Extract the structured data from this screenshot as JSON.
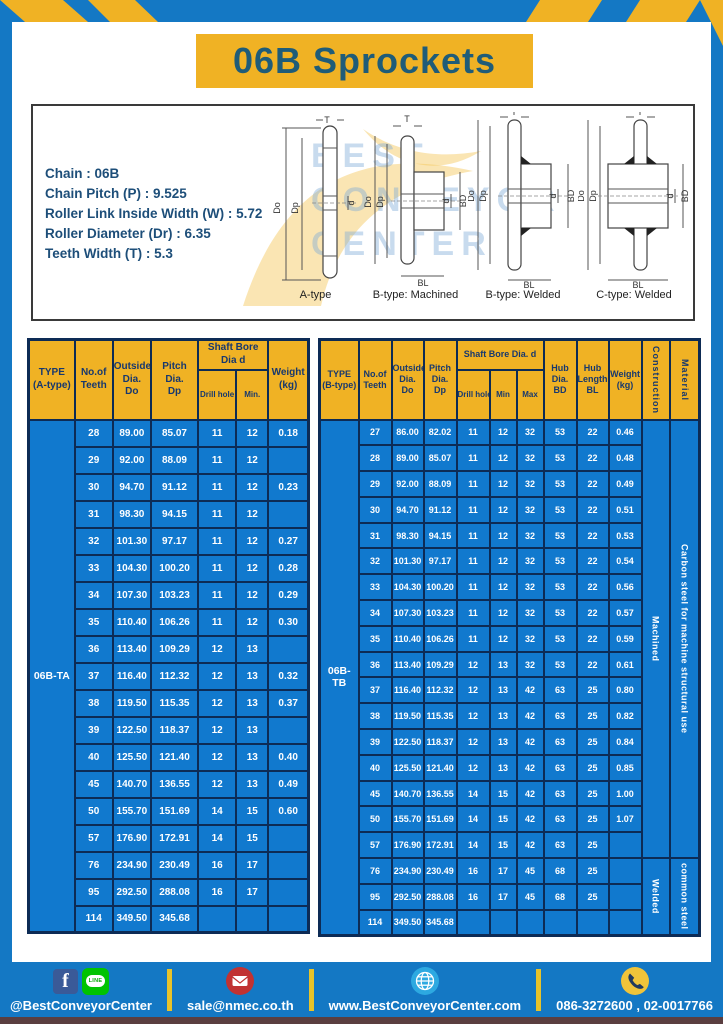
{
  "page": {
    "title": "06B Sprockets"
  },
  "specs": {
    "lines": [
      "Chain : 06B",
      "Chain Pitch (P) : 9.525",
      "Roller Link Inside Width (W) : 5.72",
      "Roller Diameter (Dr) : 6.35",
      "Teeth Width (T) : 5.3"
    ]
  },
  "diagrams": {
    "labels": [
      "A-type",
      "B-type: Machined",
      "B-type: Welded",
      "C-type: Welded"
    ],
    "watermark": [
      "BEST",
      "CONVEYOR",
      "CENTER"
    ],
    "dims": {
      "t": "T",
      "outside": "Do",
      "pitch": "Dp",
      "bore": "d",
      "hub_dia": "BD",
      "hub_len": "BL"
    }
  },
  "left_table": {
    "type_label": "06B-TA",
    "headers": {
      "type_l1": "TYPE",
      "type_l2": "(A-type)",
      "teeth_l1": "No.of",
      "teeth_l2": "Teeth",
      "outside_l1": "Outside",
      "outside_l2": "Dia.",
      "outside_l3": "Do",
      "pitch_l1": "Pitch Dia.",
      "pitch_l2": "Dp",
      "shaft_bore": "Shaft Bore Dia d",
      "drill": "Drill hole",
      "min": "Min.",
      "weight_l1": "Weight",
      "weight_l2": "(kg)"
    },
    "rows": [
      [
        "28",
        "89.00",
        "85.07",
        "11",
        "12",
        "0.18"
      ],
      [
        "29",
        "92.00",
        "88.09",
        "11",
        "12",
        ""
      ],
      [
        "30",
        "94.70",
        "91.12",
        "11",
        "12",
        "0.23"
      ],
      [
        "31",
        "98.30",
        "94.15",
        "11",
        "12",
        ""
      ],
      [
        "32",
        "101.30",
        "97.17",
        "11",
        "12",
        "0.27"
      ],
      [
        "33",
        "104.30",
        "100.20",
        "11",
        "12",
        "0.28"
      ],
      [
        "34",
        "107.30",
        "103.23",
        "11",
        "12",
        "0.29"
      ],
      [
        "35",
        "110.40",
        "106.26",
        "11",
        "12",
        "0.30"
      ],
      [
        "36",
        "113.40",
        "109.29",
        "12",
        "13",
        ""
      ],
      [
        "37",
        "116.40",
        "112.32",
        "12",
        "13",
        "0.32"
      ],
      [
        "38",
        "119.50",
        "115.35",
        "12",
        "13",
        "0.37"
      ],
      [
        "39",
        "122.50",
        "118.37",
        "12",
        "13",
        ""
      ],
      [
        "40",
        "125.50",
        "121.40",
        "12",
        "13",
        "0.40"
      ],
      [
        "45",
        "140.70",
        "136.55",
        "12",
        "13",
        "0.49"
      ],
      [
        "50",
        "155.70",
        "151.69",
        "14",
        "15",
        "0.60"
      ],
      [
        "57",
        "176.90",
        "172.91",
        "14",
        "15",
        ""
      ],
      [
        "76",
        "234.90",
        "230.49",
        "16",
        "17",
        ""
      ],
      [
        "95",
        "292.50",
        "288.08",
        "16",
        "17",
        ""
      ],
      [
        "114",
        "349.50",
        "345.68",
        "",
        "",
        ""
      ]
    ]
  },
  "right_table": {
    "type_label": "06B-TB",
    "headers": {
      "type_l1": "TYPE",
      "type_l2": "(B-type)",
      "teeth_l1": "No.of",
      "teeth_l2": "Teeth",
      "outside_l1": "Outside",
      "outside_l2": "Dia.",
      "outside_l3": "Do",
      "pitch_l1": "Pitch",
      "pitch_l2": "Dia.",
      "pitch_l3": "Dp",
      "shaft_bore": "Shaft Bore Dia. d",
      "drill": "Drill hole",
      "min": "Min",
      "max": "Max",
      "hub_dia_l1": "Hub",
      "hub_dia_l2": "Dia.",
      "hub_dia_l3": "BD",
      "hub_len_l1": "Hub",
      "hub_len_l2": "Length",
      "hub_len_l3": "BL",
      "weight_l1": "Weight",
      "weight_l2": "(kg)",
      "construction": "Construction",
      "material": "Material"
    },
    "rows": [
      [
        "27",
        "86.00",
        "82.02",
        "11",
        "12",
        "32",
        "53",
        "22",
        "0.46"
      ],
      [
        "28",
        "89.00",
        "85.07",
        "11",
        "12",
        "32",
        "53",
        "22",
        "0.48"
      ],
      [
        "29",
        "92.00",
        "88.09",
        "11",
        "12",
        "32",
        "53",
        "22",
        "0.49"
      ],
      [
        "30",
        "94.70",
        "91.12",
        "11",
        "12",
        "32",
        "53",
        "22",
        "0.51"
      ],
      [
        "31",
        "98.30",
        "94.15",
        "11",
        "12",
        "32",
        "53",
        "22",
        "0.53"
      ],
      [
        "32",
        "101.30",
        "97.17",
        "11",
        "12",
        "32",
        "53",
        "22",
        "0.54"
      ],
      [
        "33",
        "104.30",
        "100.20",
        "11",
        "12",
        "32",
        "53",
        "22",
        "0.56"
      ],
      [
        "34",
        "107.30",
        "103.23",
        "11",
        "12",
        "32",
        "53",
        "22",
        "0.57"
      ],
      [
        "35",
        "110.40",
        "106.26",
        "11",
        "12",
        "32",
        "53",
        "22",
        "0.59"
      ],
      [
        "36",
        "113.40",
        "109.29",
        "12",
        "13",
        "32",
        "53",
        "22",
        "0.61"
      ],
      [
        "37",
        "116.40",
        "112.32",
        "12",
        "13",
        "42",
        "63",
        "25",
        "0.80"
      ],
      [
        "38",
        "119.50",
        "115.35",
        "12",
        "13",
        "42",
        "63",
        "25",
        "0.82"
      ],
      [
        "39",
        "122.50",
        "118.37",
        "12",
        "13",
        "42",
        "63",
        "25",
        "0.84"
      ],
      [
        "40",
        "125.50",
        "121.40",
        "12",
        "13",
        "42",
        "63",
        "25",
        "0.85"
      ],
      [
        "45",
        "140.70",
        "136.55",
        "14",
        "15",
        "42",
        "63",
        "25",
        "1.00"
      ],
      [
        "50",
        "155.70",
        "151.69",
        "14",
        "15",
        "42",
        "63",
        "25",
        "1.07"
      ],
      [
        "57",
        "176.90",
        "172.91",
        "14",
        "15",
        "42",
        "63",
        "25",
        ""
      ],
      [
        "76",
        "234.90",
        "230.49",
        "16",
        "17",
        "45",
        "68",
        "25",
        ""
      ],
      [
        "95",
        "292.50",
        "288.08",
        "16",
        "17",
        "45",
        "68",
        "25",
        ""
      ],
      [
        "114",
        "349.50",
        "345.68",
        "",
        "",
        "",
        "",
        "",
        ""
      ]
    ],
    "construction_groups": [
      {
        "label": "Machined",
        "rows": 17
      },
      {
        "label": "Welded",
        "rows": 3
      }
    ],
    "material_groups": [
      {
        "label": "Carbon steel for machine structural use",
        "rows": 17
      },
      {
        "label": "common steel",
        "rows": 3
      }
    ]
  },
  "footer": {
    "social_handle": "@BestConveyorCenter",
    "email": "sale@nmec.co.th",
    "website": "www.BestConveyorCenter.com",
    "phone": "086-3272600 , 02-0017766",
    "line_label": "LINE"
  },
  "colors": {
    "frame_blue": "#1478c4",
    "table_blue": "#1179ce",
    "header_yellow": "#f0b224",
    "border_navy": "#0d2b55",
    "title_text": "#1f5c78"
  }
}
